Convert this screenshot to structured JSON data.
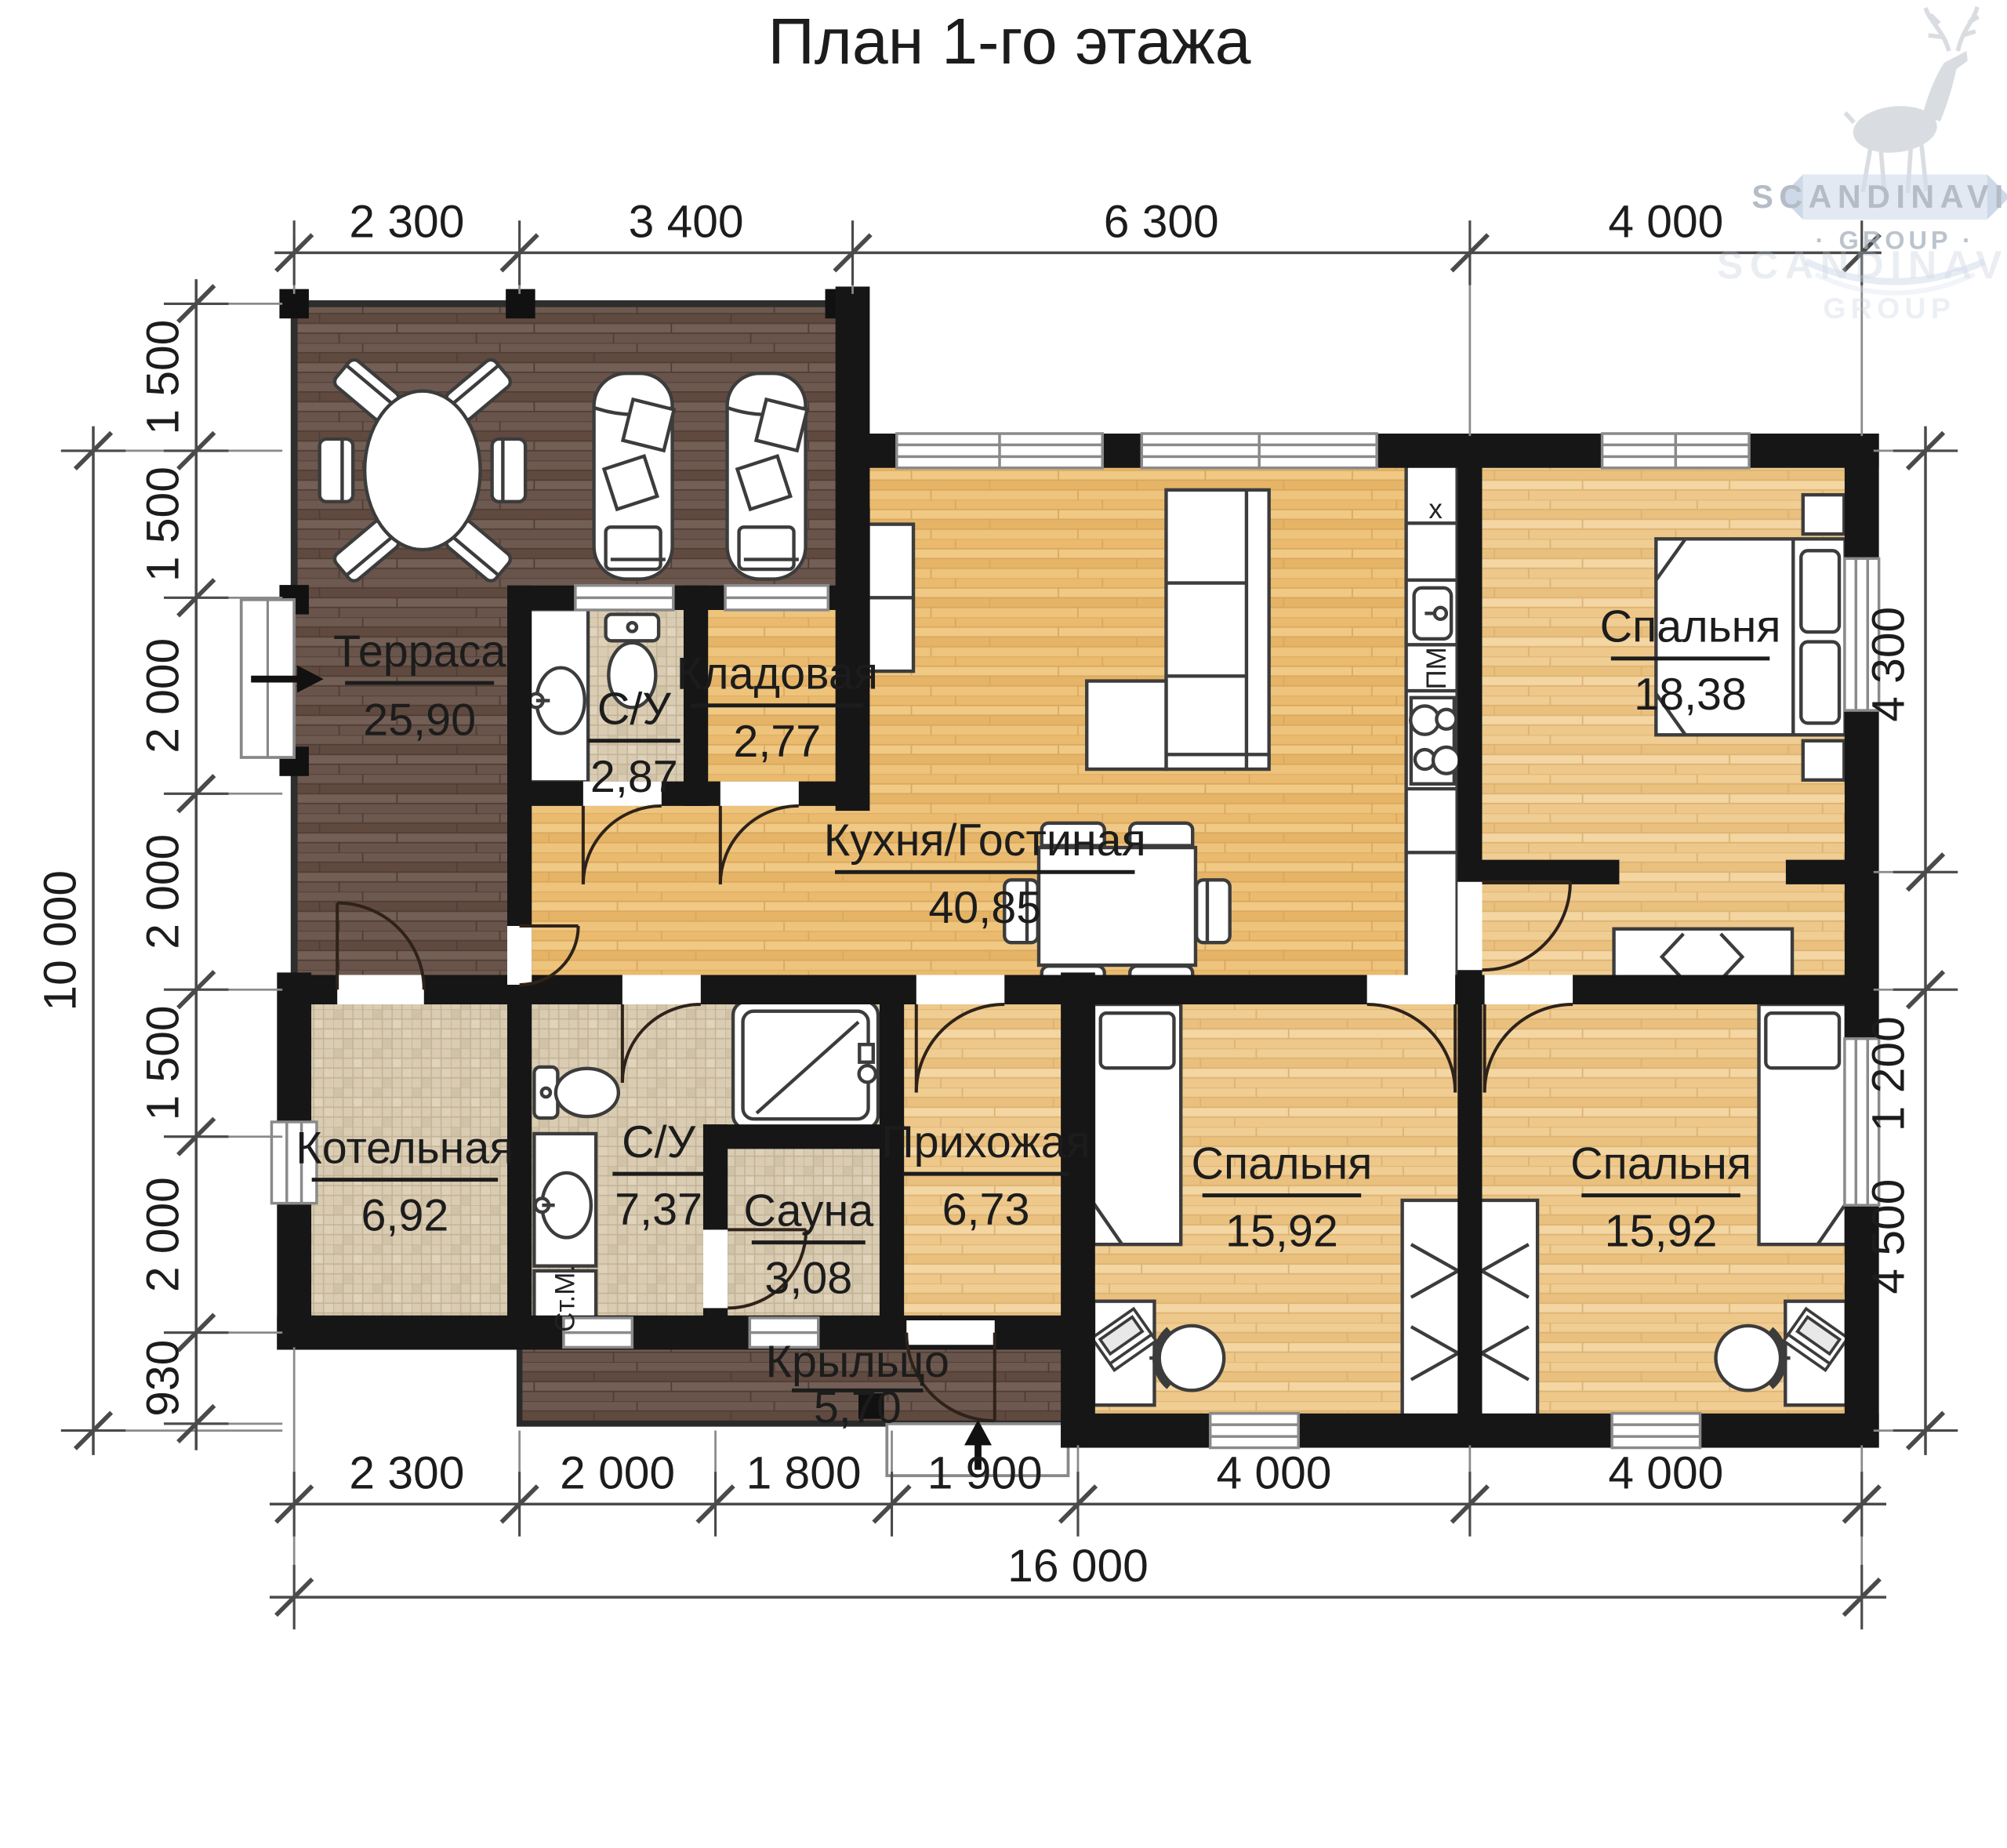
{
  "title": "План 1-го этажа",
  "watermark": {
    "name": "SCANDINAVIA",
    "group": "· GROUP ·",
    "group_plain": "GROUP"
  },
  "rooms": [
    {
      "id": "terrace",
      "name": "Терраса",
      "area": "25,90"
    },
    {
      "id": "wc-top",
      "name": "С/У",
      "area": "2,87"
    },
    {
      "id": "storage",
      "name": "Кладовая",
      "area": "2,77"
    },
    {
      "id": "kitchen-living",
      "name": "Кухня/Гостиная",
      "area": "40,85"
    },
    {
      "id": "bedroom-master",
      "name": "Спальня",
      "area": "18,38"
    },
    {
      "id": "boiler",
      "name": "Котельная",
      "area": "6,92"
    },
    {
      "id": "bathroom",
      "name": "С/У",
      "area": "7,37"
    },
    {
      "id": "sauna",
      "name": "Сауна",
      "area": "3,08"
    },
    {
      "id": "hallway",
      "name": "Прихожая",
      "area": "6,73"
    },
    {
      "id": "bedroom-left",
      "name": "Спальня",
      "area": "15,92"
    },
    {
      "id": "bedroom-right",
      "name": "Спальня",
      "area": "15,92"
    },
    {
      "id": "porch",
      "name": "Крыльцо",
      "area": "5,70"
    }
  ],
  "appliances": {
    "dishwasher": "ПМ",
    "washing_machine": "Ст.М.",
    "hob_mark": "x"
  },
  "dimensions": {
    "top": [
      "2 300",
      "3 400",
      "6 300",
      "4 000"
    ],
    "left": [
      "1 500",
      "1 500",
      "2 000",
      "2 000",
      "1 500",
      "2 000",
      "930"
    ],
    "left_total": "10 000",
    "right": [
      "4 300",
      "1 200",
      "4 500"
    ],
    "bottom": [
      "2 300",
      "2 000",
      "1 800",
      "1 900",
      "4 000",
      "4 000"
    ],
    "bottom_total": "16 000"
  },
  "colors": {
    "wall": "#161616",
    "wood_light": "#ecbe76",
    "wood_pale": "#eecb8e",
    "wood_dark": "#6b574d",
    "tile": "#d9ccb2",
    "dimension_line": "#4a4a4a",
    "watermark_blue": "#c3d2e6",
    "watermark_gray": "#cdd2d8"
  }
}
